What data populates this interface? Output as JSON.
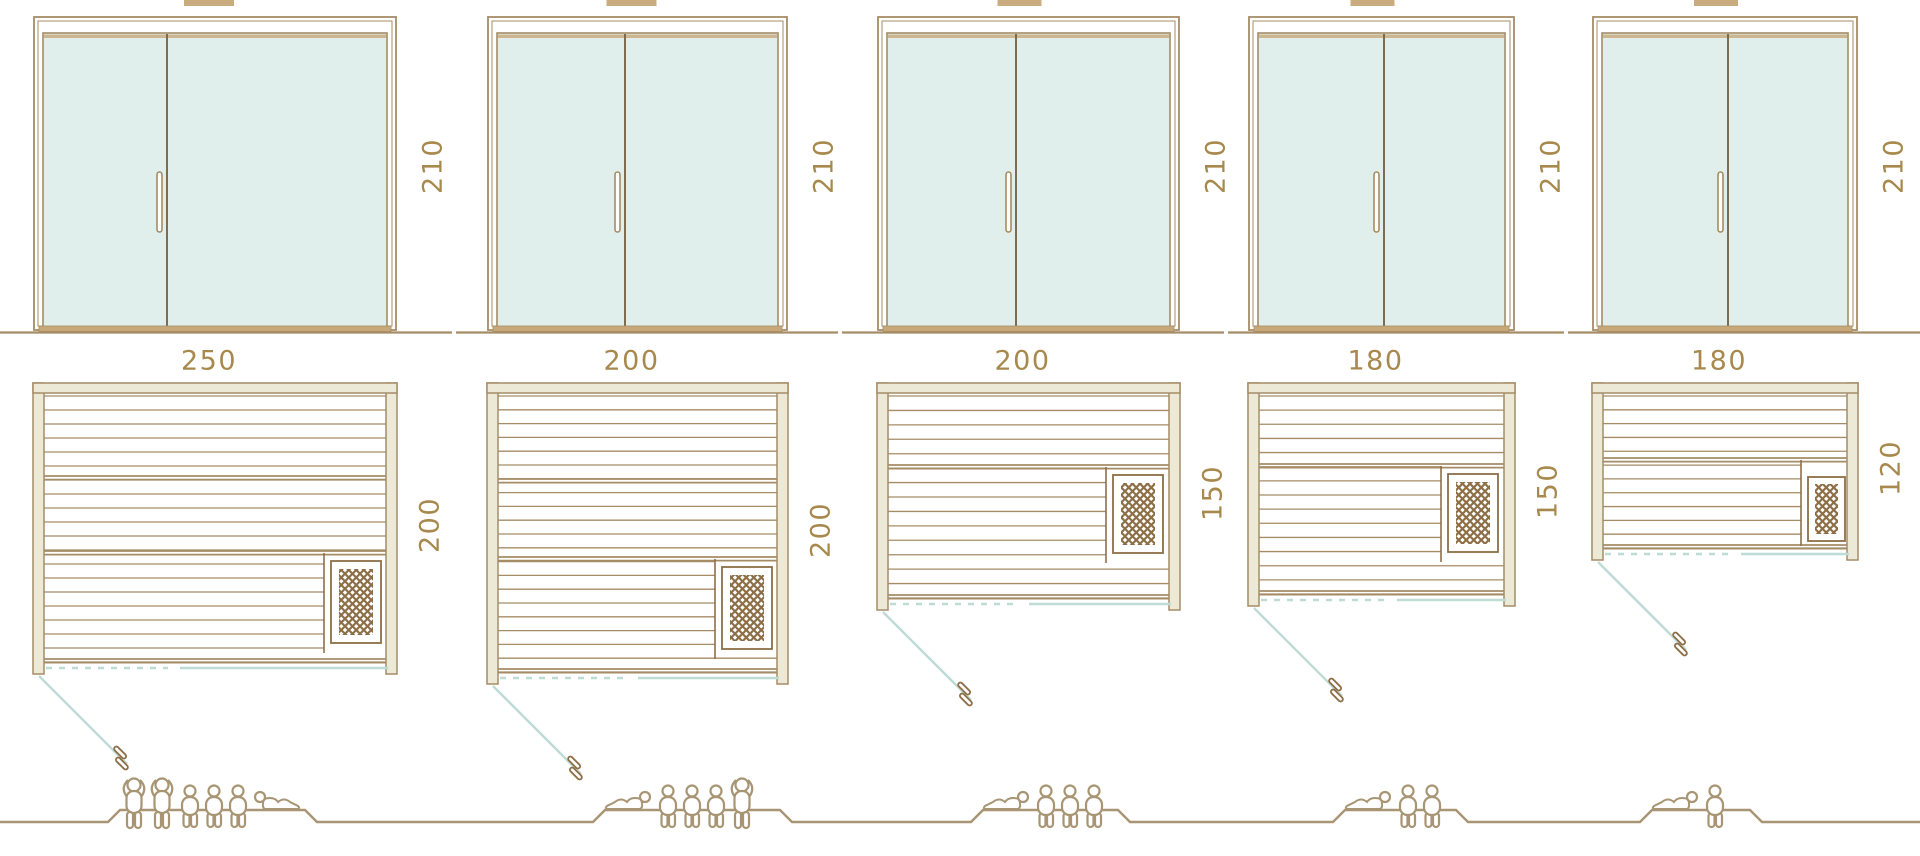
{
  "colors": {
    "outline_tan": "#a58c66",
    "dark_brown": "#8d6f47",
    "wall_cream": "#ece9d6",
    "glass_mint": "#e1efec",
    "frame_band_tan": "#c9ac7f",
    "threshold_tan": "#c8a878",
    "pale_blue_line": "#bedbd6",
    "dimension_text": "#a8894d",
    "people_outline": "#a89574",
    "background": "#ffffff"
  },
  "saunas": [
    {
      "door": {
        "height_label": "210",
        "height_cm": 210
      },
      "plan": {
        "width_label": "250",
        "width_cm": 250,
        "depth_label": "200",
        "depth_cm": 200
      },
      "capacity": {
        "total": 6,
        "figures": [
          "standing",
          "standing",
          "sitting",
          "sitting",
          "sitting",
          "lying"
        ]
      }
    },
    {
      "door": {
        "height_label": "210",
        "height_cm": 210
      },
      "plan": {
        "width_label": "200",
        "width_cm": 200,
        "depth_label": "200",
        "depth_cm": 200
      },
      "capacity": {
        "total": 5,
        "figures": [
          "lying",
          "sitting",
          "sitting",
          "sitting",
          "standing"
        ]
      }
    },
    {
      "door": {
        "height_label": "210",
        "height_cm": 210
      },
      "plan": {
        "width_label": "200",
        "width_cm": 200,
        "depth_label": "150",
        "depth_cm": 150
      },
      "capacity": {
        "total": 4,
        "figures": [
          "lying",
          "sitting",
          "sitting",
          "sitting"
        ]
      }
    },
    {
      "door": {
        "height_label": "210",
        "height_cm": 210
      },
      "plan": {
        "width_label": "180",
        "width_cm": 180,
        "depth_label": "150",
        "depth_cm": 150
      },
      "capacity": {
        "total": 3,
        "figures": [
          "lying",
          "sitting",
          "sitting"
        ]
      }
    },
    {
      "door": {
        "height_label": "210",
        "height_cm": 210
      },
      "plan": {
        "width_label": "180",
        "width_cm": 180,
        "depth_label": "120",
        "depth_cm": 120
      },
      "capacity": {
        "total": 2,
        "figures": [
          "lying",
          "sitting"
        ]
      }
    }
  ]
}
